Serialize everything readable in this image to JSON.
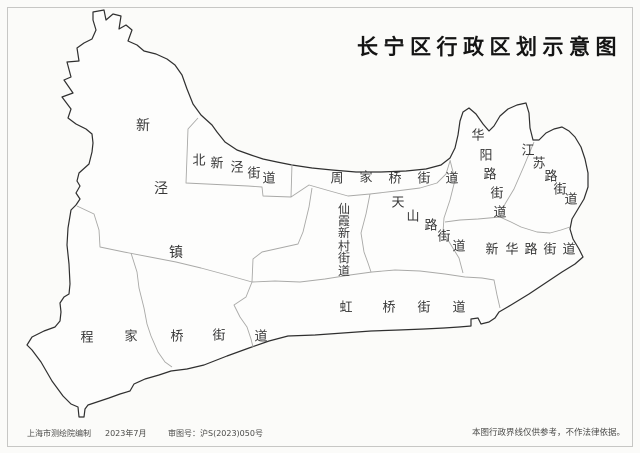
{
  "title": "长宁区行政区划示意图",
  "footer": {
    "publisher": "上海市测绘院编制",
    "date": "2023年7月",
    "approval": "审图号：沪S(2023)050号",
    "disclaimer": "本图行政界线仅供参考，不作法律依据。"
  },
  "map": {
    "colors": {
      "fill": "#fdfdfc",
      "outer_stroke": "#2f2f2f",
      "inner_stroke": "#a9a9a7",
      "label": "#373737"
    },
    "outer_boundary": "93,12 104,10 106,20 113,14 121,16 119,29 126,25 132,30 128,41 137,45 144,51 156,54 167,59 175,65 182,75 187,89 193,104 201,115 212,125 217,132 225,142 237,150 251,155 263,159 277,162 292,165 312,168 332,170 356,172 381,172 406,171 426,169 441,165 450,158 455,148 458,135 460,121 463,112 469,108 476,114 483,124 489,131 494,126 500,116 508,109 517,105 526,103 529,113 530,128 533,140 539,140 546,133 554,129 562,127 569,131 575,137 581,147 585,159 588,173 588,187 584,199 578,209 572,219 570,229 573,239 579,249 583,257 575,264 562,272 547,282 529,294 511,305 499,312 495,318 489,322 481,324 478,318 471,319 471,326 459,327 444,328 424,329 399,330 371,331 343,333 315,335 288,336 269,341 249,348 227,356 204,365 187,369 171,371 159,375 145,379 134,384 130,391 120,394 109,398 97,402 88,405 85,409 84,417 79,417 78,407 71,404 63,396 52,381 41,362 32,350 27,345 32,337 44,331 55,327 60,321 61,312 60,303 64,297 69,294 70,284 69,264 67,245 68,228 71,210 76,205 80,199 76,193 80,186 77,181 79,173 89,164 92,152 93,143 92,134 86,129 76,124 68,118 71,109 62,97 73,93 64,80 71,77 67,62 79,61 77,48 84,43 92,39 96,30 93,20",
    "inner_boundaries": [
      {
        "name": "beixinjing-boundary",
        "points": "198,118 188,129 186,183 248,186 262,187 263,196 291,197 292,164"
      },
      {
        "name": "zhoujiaqiao-south-boundary",
        "points": "291,197 309,185 330,191 348,196 370,194 396,191 420,188 437,183 446,174 450,161"
      },
      {
        "name": "xianxia-west-boundary",
        "points": "312,188 309,207 303,232 298,244 262,252 253,259 252,282"
      },
      {
        "name": "xianxia-tianshan-boundary",
        "points": "370,194 366,214 361,233 364,252 368,263 371,272"
      },
      {
        "name": "tianshan-east-boundary",
        "points": "450,160 455,180 450,200 444,218 443,232 451,245 459,258 463,273"
      },
      {
        "name": "huayang-jiangsu-boundary",
        "points": "534,142 524,166 514,189 505,204 500,217"
      },
      {
        "name": "xinhua-north-boundary",
        "points": "445,222 460,220 478,219 500,217 511,222 521,227 537,232 550,233 561,230 570,227"
      },
      {
        "name": "hongqiao-north-boundary",
        "points": "252,282 275,281 300,282 325,279 350,275 372,272 395,270 420,271 445,274 465,277 482,278 494,280 497,295 500,308"
      },
      {
        "name": "xinjing-south-boundary",
        "points": "77,206 94,214 99,230 100,247 124,252 150,257 176,262 201,268 227,275 252,282"
      },
      {
        "name": "chengjiaqiao-hongqiao-boundary",
        "points": "252,282 246,297 234,305 240,317 247,327 251,339 253,347"
      },
      {
        "name": "chengjiaqiao-inner-boundary",
        "points": "131,253 137,272 139,288 144,308 147,324 151,336 158,352 165,362 172,367"
      }
    ],
    "labels": [
      {
        "name": "xinjing-town",
        "text": "新泾镇",
        "size": 14,
        "chars": [
          [
            143,
            126
          ],
          [
            161,
            189
          ],
          [
            176,
            253
          ]
        ]
      },
      {
        "name": "beixinjing-subdistrict",
        "text": "北新泾街道",
        "size": 13,
        "chars": [
          [
            199,
            161
          ],
          [
            217,
            164
          ],
          [
            237,
            168
          ],
          [
            254,
            174
          ],
          [
            269,
            179
          ]
        ]
      },
      {
        "name": "zhoujiaqiao-subdistrict",
        "text": "周家桥街道",
        "size": 13,
        "chars": [
          [
            337,
            179
          ],
          [
            366,
            178
          ],
          [
            395,
            179
          ],
          [
            424,
            179
          ],
          [
            452,
            179
          ]
        ]
      },
      {
        "name": "xianxia-xincun-subdistrict",
        "text": "仙霞新村街道",
        "size": 12,
        "chars": [
          [
            344,
            209
          ],
          [
            344,
            221
          ],
          [
            344,
            233
          ],
          [
            344,
            246
          ],
          [
            344,
            258
          ],
          [
            344,
            271
          ]
        ]
      },
      {
        "name": "tianshan-road-subdistrict",
        "text": "天山路街道",
        "size": 13,
        "chars": [
          [
            398,
            203
          ],
          [
            413,
            217
          ],
          [
            431,
            226
          ],
          [
            444,
            237
          ],
          [
            459,
            247
          ]
        ]
      },
      {
        "name": "huayang-road-subdistrict",
        "text": "华阳路街道",
        "size": 13,
        "chars": [
          [
            478,
            136
          ],
          [
            486,
            156
          ],
          [
            490,
            175
          ],
          [
            497,
            194
          ],
          [
            500,
            213
          ]
        ]
      },
      {
        "name": "jiangsu-road-subdistrict",
        "text": "江苏路街道",
        "size": 13,
        "chars": [
          [
            528,
            151
          ],
          [
            539,
            164
          ],
          [
            551,
            177
          ],
          [
            560,
            190
          ],
          [
            571,
            200
          ]
        ]
      },
      {
        "name": "xinhua-road-subdistrict",
        "text": "新华路街道",
        "size": 13,
        "chars": [
          [
            492,
            250
          ],
          [
            512,
            250
          ],
          [
            531,
            250
          ],
          [
            550,
            250
          ],
          [
            569,
            250
          ]
        ]
      },
      {
        "name": "hongqiao-subdistrict",
        "text": "虹桥街道",
        "size": 13,
        "chars": [
          [
            346,
            308
          ],
          [
            389,
            308
          ],
          [
            424,
            308
          ],
          [
            459,
            308
          ]
        ]
      },
      {
        "name": "chengjiaqiao-subdistrict",
        "text": "程家桥街道",
        "size": 13,
        "chars": [
          [
            87,
            338
          ],
          [
            131,
            337
          ],
          [
            177,
            337
          ],
          [
            219,
            336
          ],
          [
            261,
            337
          ]
        ]
      }
    ]
  }
}
